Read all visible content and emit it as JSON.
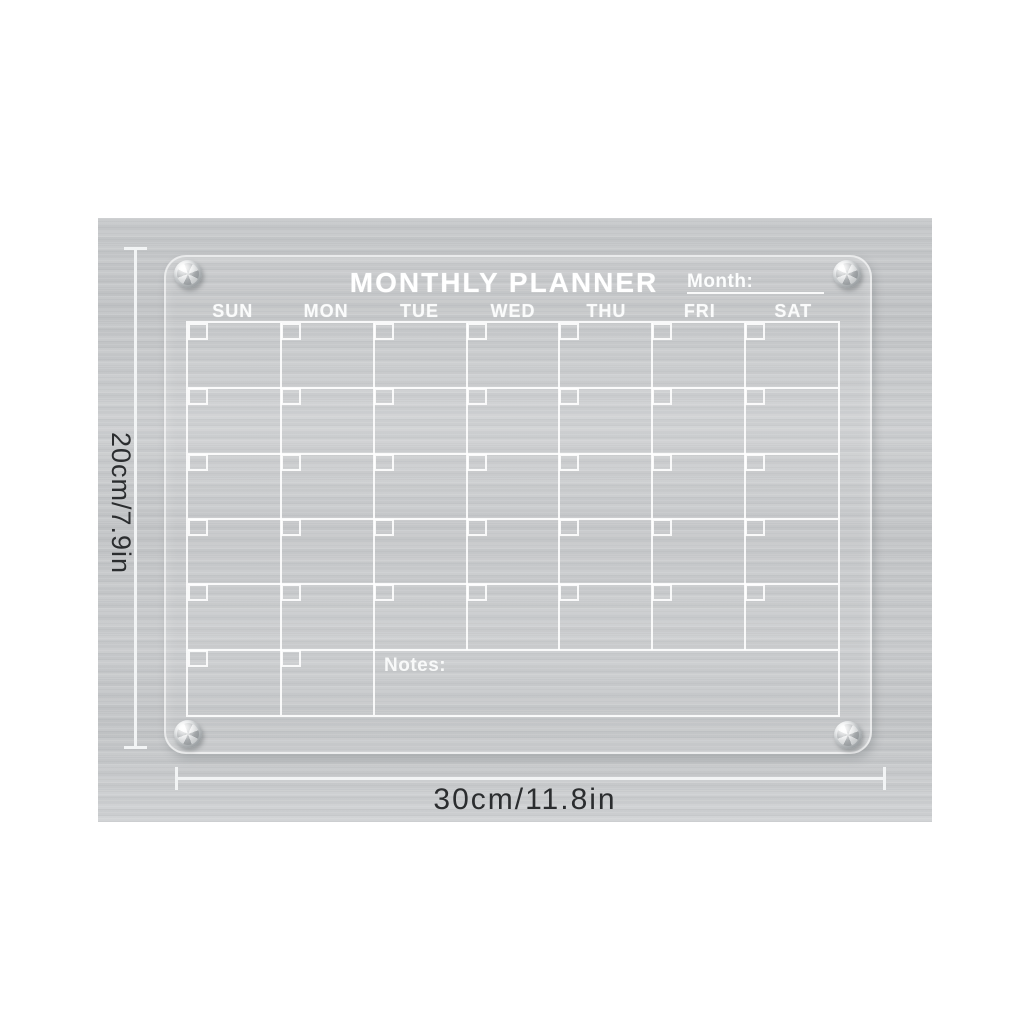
{
  "planner": {
    "title": "MONTHLY PLANNER",
    "month_label": "Month:",
    "notes_label": "Notes:",
    "day_headers": [
      "SUN",
      "MON",
      "TUE",
      "WED",
      "THU",
      "FRI",
      "SAT"
    ],
    "grid": {
      "rows": 6,
      "cols": 7,
      "last_row_day_cells": 2
    },
    "hardware": {
      "corner_screws": 4
    }
  },
  "dimension_annotations": {
    "height_label": "20cm/7.9in",
    "width_label": "30cm/11.8in"
  },
  "colors": {
    "background_white": "#ffffff",
    "metal_gray": "#c6c8ca",
    "marking_white": "#f4f5f6",
    "dimension_text": "#2b2d2f"
  }
}
